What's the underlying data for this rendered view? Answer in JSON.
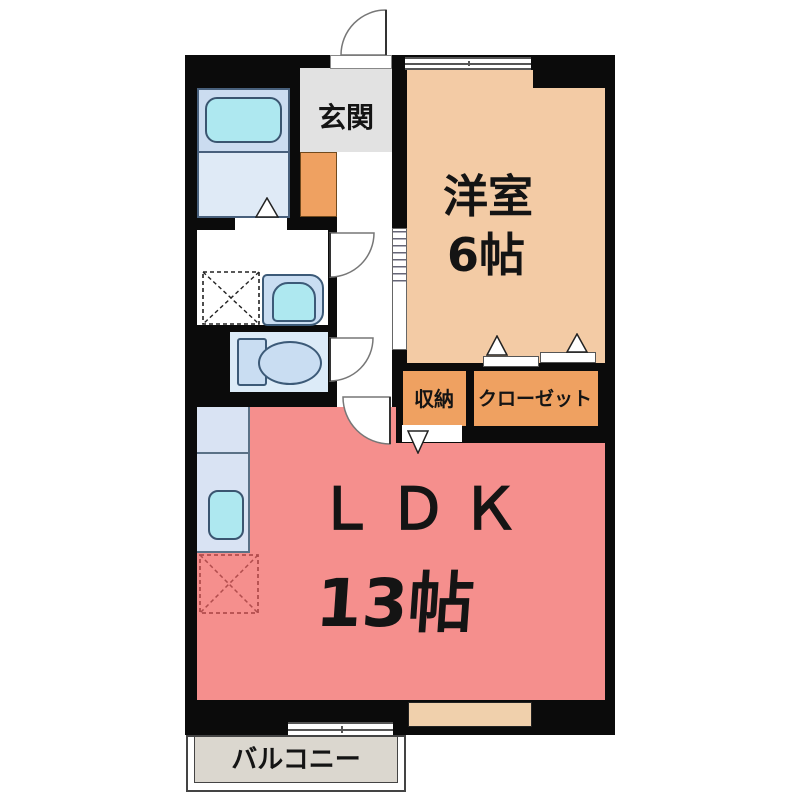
{
  "rooms": {
    "genkan": {
      "label": "玄関"
    },
    "western_room": {
      "label": "洋室",
      "size": "6帖"
    },
    "storage": {
      "label": "収納"
    },
    "closet": {
      "label": "クローゼット"
    },
    "ldk": {
      "label": "ＬＤＫ",
      "size": "13帖"
    },
    "balcony": {
      "label": "バルコニー"
    }
  },
  "fixtures": [
    "bathtub",
    "wash-basin",
    "washing-machine-space",
    "toilet",
    "kitchen-sink",
    "refrigerator-space"
  ],
  "colors": {
    "wall": "#0b0b0b",
    "western_room": "#f3cba5",
    "closet_orange": "#efa161",
    "ldk_pink": "#f58f8d",
    "genkan_gray": "#e2e2e2",
    "balcony_gray": "#dbd7cf",
    "bath_floor_upper": "#cbdcf0",
    "bath_floor_lower": "#dfeaf6",
    "water_cyan": "#aee8f0",
    "fixture_blue": "#c9ddf2",
    "kitchen_counter": "#d9e3f3",
    "toilet_room_blue": "#dcebf8",
    "wall_inset_tan": "#f0d0ac"
  }
}
